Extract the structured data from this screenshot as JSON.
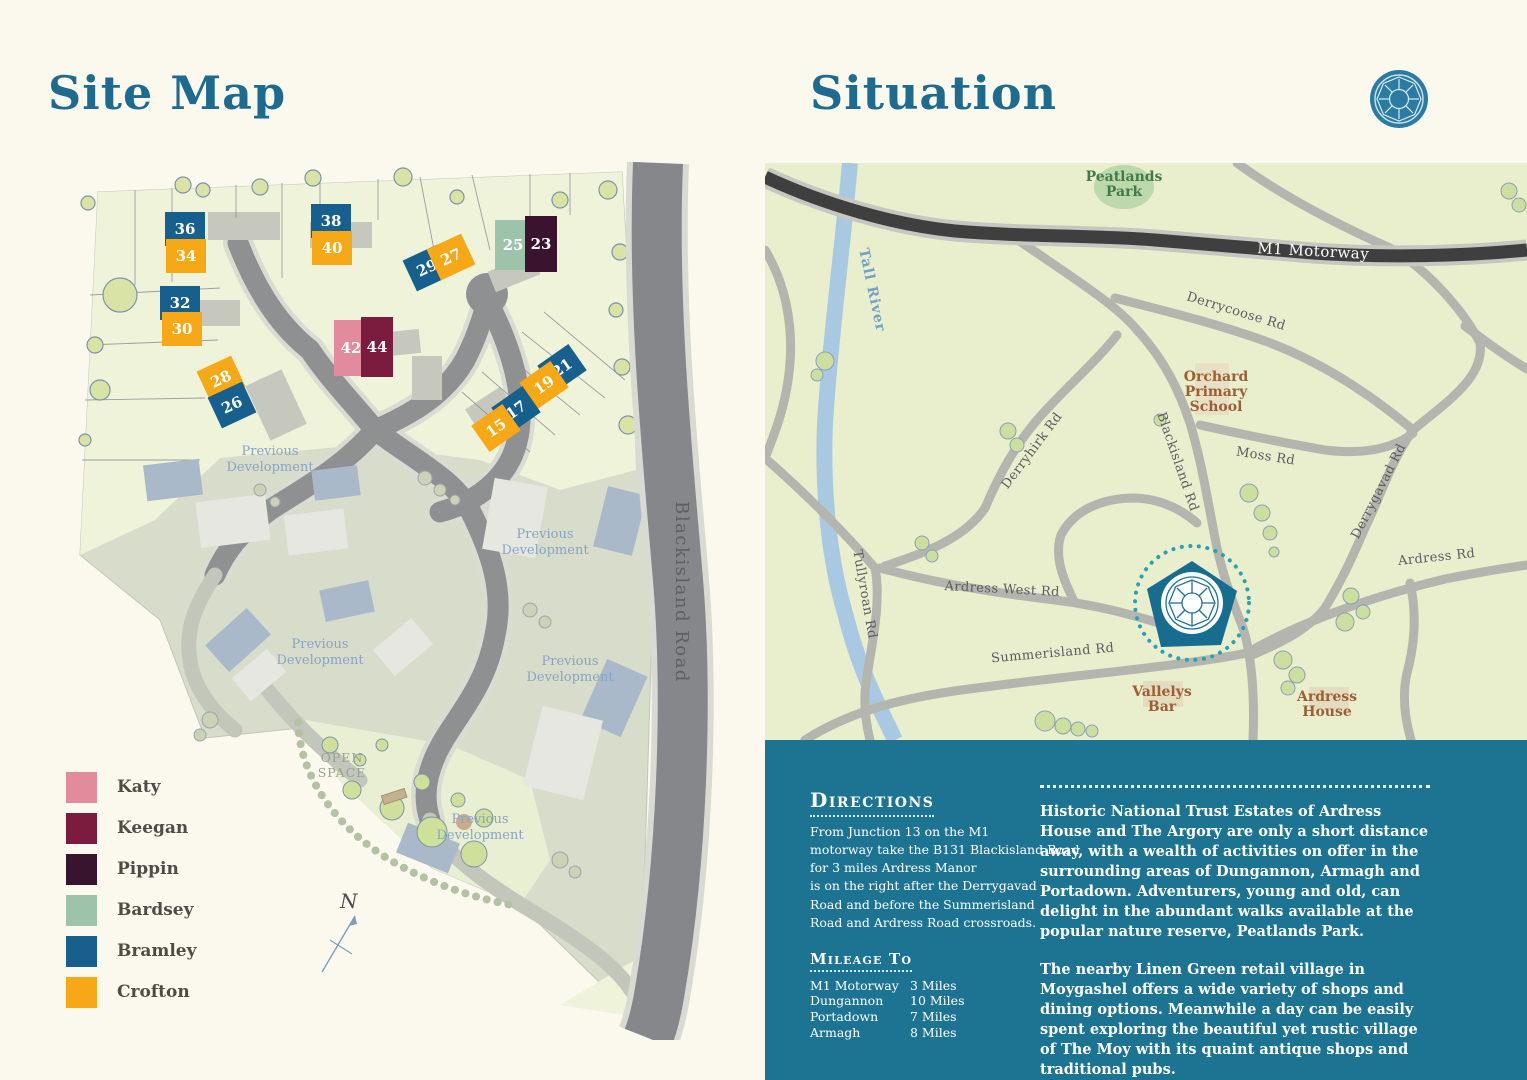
{
  "site_map": {
    "title": "Site Map",
    "road_label": "Blackisland Road",
    "open_space": "OPEN\nSPACE",
    "compass": "N",
    "previous_development": {
      "text": "Previous\nDevelopment",
      "positions": [
        [
          210,
          295
        ],
        [
          485,
          378
        ],
        [
          260,
          488
        ],
        [
          510,
          505
        ],
        [
          420,
          663
        ]
      ]
    },
    "legend": [
      {
        "key": "katy",
        "name": "Katy",
        "color": "#e28b9d"
      },
      {
        "key": "keegan",
        "name": "Keegan",
        "color": "#7b1c3e"
      },
      {
        "key": "pippin",
        "name": "Pippin",
        "color": "#39142f"
      },
      {
        "key": "bardsey",
        "name": "Bardsey",
        "color": "#9dc3aa"
      },
      {
        "key": "bramley",
        "name": "Bramley",
        "color": "#175f8c"
      },
      {
        "key": "crofton",
        "name": "Crofton",
        "color": "#f7a817"
      }
    ],
    "plots": [
      {
        "num": "36",
        "type": "bramley",
        "x": 125,
        "y": 69,
        "w": 40,
        "h": 34,
        "rot": 0
      },
      {
        "num": "34",
        "type": "crofton",
        "x": 126,
        "y": 96,
        "w": 40,
        "h": 34,
        "rot": 0
      },
      {
        "num": "38",
        "type": "bramley",
        "x": 271,
        "y": 61,
        "w": 40,
        "h": 34,
        "rot": 0
      },
      {
        "num": "40",
        "type": "crofton",
        "x": 272,
        "y": 88,
        "w": 40,
        "h": 34,
        "rot": 0
      },
      {
        "num": "29",
        "type": "bramley",
        "x": 367,
        "y": 108,
        "w": 38,
        "h": 34,
        "rot": -25
      },
      {
        "num": "27",
        "type": "crofton",
        "x": 391,
        "y": 97,
        "w": 38,
        "h": 34,
        "rot": -25
      },
      {
        "num": "25",
        "type": "bardsey",
        "x": 453,
        "y": 85,
        "w": 36,
        "h": 50,
        "rot": 0
      },
      {
        "num": "23",
        "type": "pippin",
        "x": 481,
        "y": 84,
        "w": 32,
        "h": 56,
        "rot": 0
      },
      {
        "num": "32",
        "type": "bramley",
        "x": 120,
        "y": 143,
        "w": 40,
        "h": 34,
        "rot": 0
      },
      {
        "num": "30",
        "type": "crofton",
        "x": 122,
        "y": 169,
        "w": 40,
        "h": 34,
        "rot": 0
      },
      {
        "num": "42",
        "type": "katy",
        "x": 291,
        "y": 188,
        "w": 34,
        "h": 56,
        "rot": 0
      },
      {
        "num": "44",
        "type": "keegan",
        "x": 317,
        "y": 187,
        "w": 32,
        "h": 60,
        "rot": 0
      },
      {
        "num": "28",
        "type": "crofton",
        "x": 161,
        "y": 219,
        "w": 38,
        "h": 34,
        "rot": -25
      },
      {
        "num": "26",
        "type": "bramley",
        "x": 172,
        "y": 245,
        "w": 38,
        "h": 34,
        "rot": -25
      },
      {
        "num": "21",
        "type": "bramley",
        "x": 502,
        "y": 208,
        "w": 38,
        "h": 32,
        "rot": -35
      },
      {
        "num": "19",
        "type": "crofton",
        "x": 484,
        "y": 225,
        "w": 38,
        "h": 32,
        "rot": -35
      },
      {
        "num": "17",
        "type": "bramley",
        "x": 456,
        "y": 250,
        "w": 38,
        "h": 32,
        "rot": -35
      },
      {
        "num": "15",
        "type": "crofton",
        "x": 436,
        "y": 268,
        "w": 38,
        "h": 32,
        "rot": -35
      }
    ]
  },
  "situation": {
    "title": "Situation",
    "labels": [
      {
        "text": "Peatlands\nPark",
        "x": 359,
        "y": 18,
        "rot": 0,
        "cls": "poi-green"
      },
      {
        "text": "M1 Motorway",
        "x": 548,
        "y": 93,
        "rot": 3,
        "cls": "m1-lbl"
      },
      {
        "text": "Derrycoose Rd",
        "x": 470,
        "y": 152,
        "rot": 17,
        "cls": "road-lbl"
      },
      {
        "text": "Orchard\nPrimary\nSchool",
        "x": 451,
        "y": 218,
        "rot": 0,
        "cls": "poi-brown"
      },
      {
        "text": "Derryhirk Rd",
        "x": 270,
        "y": 290,
        "rot": -53,
        "cls": "road-lbl"
      },
      {
        "text": "Blackisland Rd",
        "x": 409,
        "y": 300,
        "rot": 71,
        "cls": "road-lbl"
      },
      {
        "text": "Moss Rd",
        "x": 500,
        "y": 297,
        "rot": 9,
        "cls": "road-lbl"
      },
      {
        "text": "Derrygavad Rd",
        "x": 617,
        "y": 330,
        "rot": -63,
        "cls": "road-lbl"
      },
      {
        "text": "Ardress Rd",
        "x": 672,
        "y": 398,
        "rot": -6,
        "cls": "road-lbl"
      },
      {
        "text": "Tall River",
        "x": 103,
        "y": 128,
        "rot": 78,
        "cls": "river-lbl"
      },
      {
        "text": "Tullyroan Rd",
        "x": 96,
        "y": 432,
        "rot": 80,
        "cls": "road-lbl"
      },
      {
        "text": "Ardress West Rd",
        "x": 237,
        "y": 430,
        "rot": 3,
        "cls": "road-lbl"
      },
      {
        "text": "Summerisland Rd",
        "x": 288,
        "y": 494,
        "rot": -5,
        "cls": "road-lbl"
      },
      {
        "text": "Vallelys\nBar",
        "x": 397,
        "y": 533,
        "rot": 0,
        "cls": "poi-brown"
      },
      {
        "text": "Ardress\nHouse",
        "x": 562,
        "y": 538,
        "rot": 0,
        "cls": "poi-brown"
      }
    ]
  },
  "panel": {
    "directions_title": "Directions",
    "directions_body": "From Junction 13 on the M1\nmotorway take the B131 Blackisland Road\nfor 3 miles Ardress Manor\nis on the right after the Derrygavad\nRoad and before the Summerisland\nRoad and Ardress Road crossroads.",
    "mileage_title": "Mileage To",
    "mileage": [
      {
        "place": "M1 Motorway",
        "distance": "3 Miles"
      },
      {
        "place": "Dungannon",
        "distance": "10 Miles"
      },
      {
        "place": "Portadown",
        "distance": "7 Miles"
      },
      {
        "place": "Armagh",
        "distance": "8 Miles"
      }
    ],
    "para1": "Historic National Trust Estates of Ardress House and The Argory are only a short distance away, with a wealth of activities on offer in the surrounding areas of Dungannon, Armagh and Portadown. Adventurers, young and old, can delight in the abundant walks available at the popular nature reserve, Peatlands Park.",
    "para2": "The nearby Linen Green retail village in Moygashel offers a wide variety of shops and dining options. Meanwhile a day can be easily spent exploring the beautiful yet rustic village of The Moy with its quaint antique shops and traditional pubs."
  }
}
